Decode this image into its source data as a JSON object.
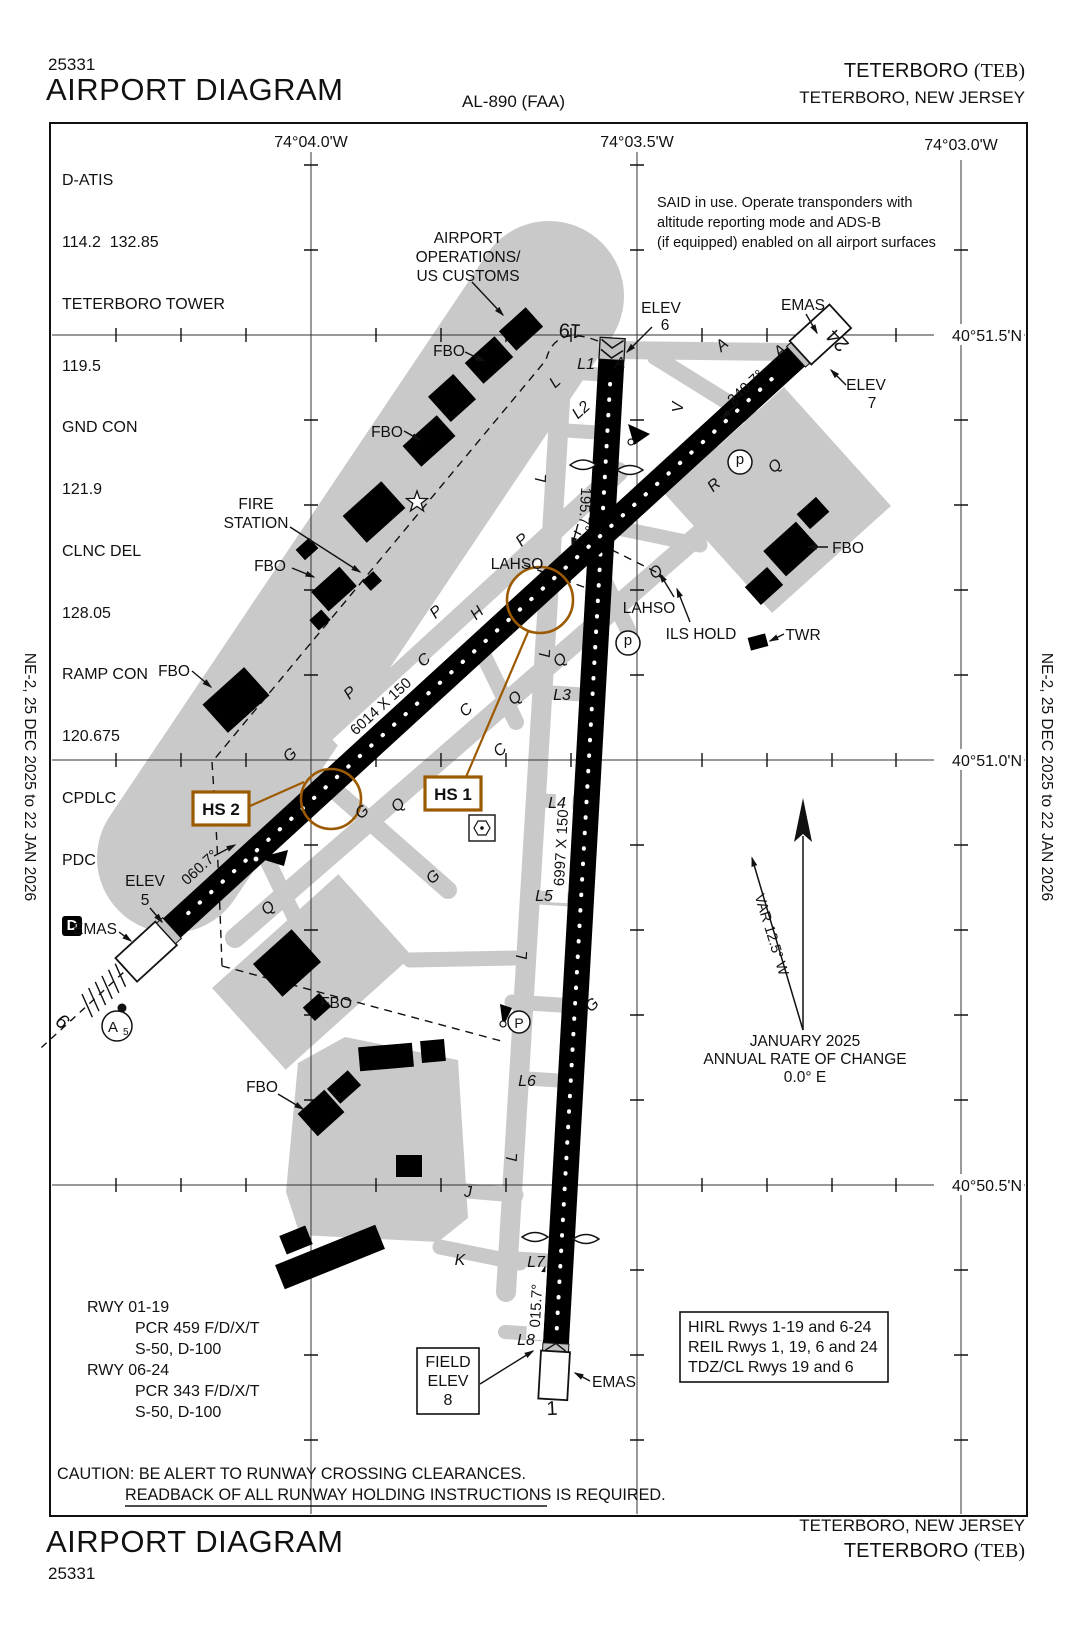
{
  "header": {
    "chart_number": "25331",
    "title": "AIRPORT DIAGRAM",
    "al_number": "AL-890 (FAA)",
    "airport_name": "TETERBORO",
    "airport_ident": "(TEB)",
    "city": "TETERBORO, NEW JERSEY"
  },
  "margin_text": "NE-2, 25 DEC 2025 to 22 JAN 2026",
  "freqs": {
    "datis": "D-ATIS",
    "datis_v": "114.2  132.85",
    "twr": "TETERBORO TOWER",
    "twr_v": "119.5",
    "gnd": "GND CON",
    "gnd_v": "121.9",
    "clnc": "CLNC DEL",
    "clnc_v": "128.05",
    "ramp": "RAMP CON",
    "ramp_v": "120.675",
    "cpdlc": "CPDLC",
    "pdc": "PDC",
    "d": "D"
  },
  "grid": {
    "lon_a": "74°04.0'W",
    "lon_b": "74°03.5'W",
    "lon_c": "74°03.0'W",
    "lat_a": "40°51.5'N",
    "lat_b": "40°51.0'N",
    "lat_c": "40°50.5'N"
  },
  "notes": {
    "said1": "SAID in use. Operate transponders with",
    "said2": "altitude reporting mode and ADS-B",
    "said3": "(if equipped) enabled on all airport surfaces",
    "caution1": "CAUTION: BE ALERT TO RUNWAY CROSSING CLEARANCES.",
    "caution2": "READBACK OF ALL RUNWAY HOLDING INSTRUCTIONS IS REQUIRED."
  },
  "compass": {
    "var": "VAR 12.5° W",
    "date": "JANUARY 2025",
    "rate1": "ANNUAL RATE OF CHANGE",
    "rate2": "0.0° E"
  },
  "runways": {
    "r19": "19",
    "r1": "1",
    "r6": "6",
    "r24": "24",
    "dim_0119": "6997 X 150",
    "dim_0624": "6014 X 150",
    "hdg19": "195.7°",
    "hdg1": "015.7°",
    "hdg6": "060.7°",
    "hdg24": "240.7°"
  },
  "elev": {
    "label": "ELEV",
    "e5": "5",
    "e6": "6",
    "e7": "7",
    "field1": "FIELD",
    "field2": "ELEV",
    "field3": "8"
  },
  "poi": {
    "emas": "EMAS",
    "fbo": "FBO",
    "fire1": "FIRE",
    "fire2": "STATION",
    "ops1": "AIRPORT",
    "ops2": "OPERATIONS/",
    "ops3": "US CUSTOMS",
    "lahso": "LAHSO",
    "ils_hold": "ILS HOLD",
    "twr": "TWR",
    "hs1": "HS 1",
    "hs2": "HS 2",
    "a5_main": "A",
    "a5_sub": "5",
    "deice": "d",
    "pcircle": "P"
  },
  "twy": {
    "a": "A",
    "c": "C",
    "g": "G",
    "h": "H",
    "j": "J",
    "k": "K",
    "l": "L",
    "p": "P",
    "q": "Q",
    "r": "R",
    "v": "V",
    "l1": "L1",
    "l2": "L2",
    "l3": "L3",
    "l4": "L4",
    "l5": "L5",
    "l6": "L6",
    "l7": "L7",
    "l8": "L8"
  },
  "rwy_info": {
    "r119": "RWY 01-19",
    "r119_pcr": "PCR 459 F/D/X/T",
    "r119_s": "S-50, D-100",
    "r624": "RWY 06-24",
    "r624_pcr": "PCR 343 F/D/X/T",
    "r624_s": "S-50, D-100"
  },
  "lighting": {
    "l1": "HIRL Rwys 1-19 and 6-24",
    "l2": "REIL Rwys 1, 19, 6 and 24",
    "l3": "TDZ/CL Rwys 19 and 6"
  },
  "colors": {
    "hotspot": "#9c5a00",
    "apron": "#c9c9c9"
  }
}
